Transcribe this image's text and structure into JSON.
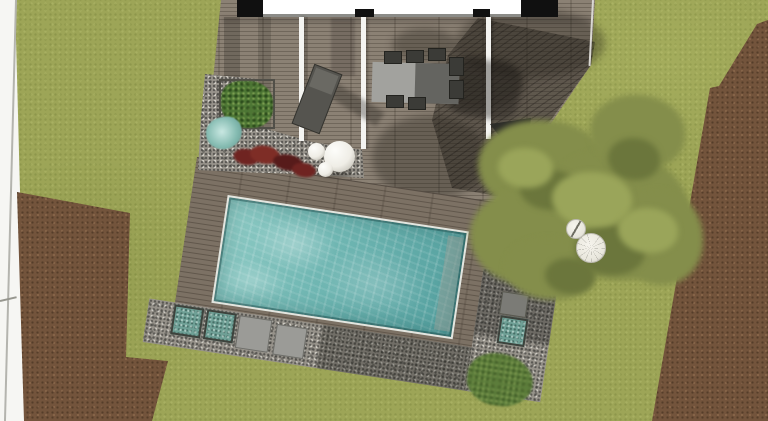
{
  "scene": {
    "kind": "landscape-pool-plan-top-view",
    "elements": [
      {
        "name": "house-floorplan",
        "desc": "building footprint with black walls and white interior, top edge"
      },
      {
        "name": "wood-deck",
        "desc": "plank terrace attached to house with white pergola beams"
      },
      {
        "name": "sun-lounger",
        "desc": "dark lounge chair on deck"
      },
      {
        "name": "dining-set",
        "desc": "grey table with dark chairs on deck"
      },
      {
        "name": "swimming-pool",
        "desc": "rotated rectangular pool with turquoise water and submerged bench"
      },
      {
        "name": "pool-terrace",
        "desc": "rotated wood deck surrounding pool with gravel borders"
      },
      {
        "name": "gravel-bed",
        "desc": "planting bed with box shrub, teal grass, red plants and white spheres"
      },
      {
        "name": "decor-spheres",
        "desc": "three white decorative spheres"
      },
      {
        "name": "stepping-stones",
        "desc": "square pavers in gravel strip"
      },
      {
        "name": "square-planters",
        "desc": "teal box planters in gravel"
      },
      {
        "name": "tree-canopy",
        "desc": "large olive-green tree overhanging terrace"
      },
      {
        "name": "parasol-table-set",
        "desc": "round white parasol and small table on lawn"
      },
      {
        "name": "dark-water-feature",
        "desc": "dark triangular element at deck edge"
      },
      {
        "name": "lawn",
        "desc": "olive green grass ground"
      },
      {
        "name": "mulch-bed-left",
        "desc": "brown soil bed lower left"
      },
      {
        "name": "mulch-bed-right",
        "desc": "brown soil strip along right edge"
      },
      {
        "name": "property-margin",
        "desc": "white page margin with boundary lines, left edge"
      }
    ]
  },
  "colors": {
    "grass": "#9da557",
    "mulch": "#73543c",
    "deck_wood": "#8b8174",
    "terrace_wood": "#7c7164",
    "gravel": "#97938b",
    "water_light": "#8fcbc5",
    "water_mid": "#6fb6b2",
    "water_dark": "#539f9e",
    "coping": "#e3e6e0",
    "wall_black": "#101010",
    "building_floor": "#ffffff",
    "beam_white": "#f4f4f1",
    "boundary_white": "#fbfbf8",
    "page_white": "#f6f6f3",
    "foliage": "#848e4b",
    "foliage_dark": "#6b763c",
    "foliage_light": "#9aa55a",
    "bush_green": "#4d7634",
    "bush_light": "#5c7d3b",
    "teal_plant": "#86bcb2",
    "planter_teal": "#6fa096",
    "red_plant": "#6f2421",
    "red_plant_dark": "#571b1a",
    "furniture_dark": "#3b3b37",
    "lounge_gray": "#55544f",
    "table_gray": "#a2a29e",
    "table_shadow": "#646460",
    "stone_gray": "#9b9b97",
    "pad_gray": "#7b7b76",
    "sphere": "#efede6",
    "line_gray": "#8c8c88"
  }
}
